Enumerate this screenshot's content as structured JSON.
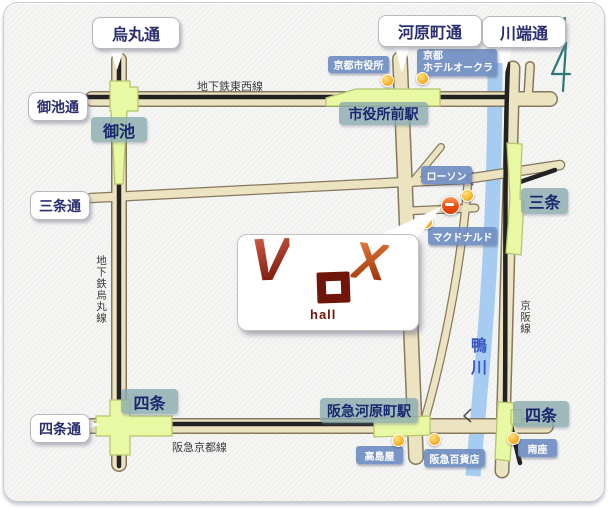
{
  "balloons": {
    "karasuma": "烏丸通",
    "kawaramachi": "河原町通",
    "kawabata": "川端通",
    "oike": "御池通",
    "sanjo": "三条通",
    "shijo": "四条通"
  },
  "stations": {
    "oike": "御池",
    "shiyakushomae": "市役所前駅",
    "sanjo": "三条",
    "shijo_karasuma": "四条",
    "hankyu_kawaramachi": "阪急河原町駅",
    "shijo_keihan": "四条"
  },
  "landmarks": {
    "city_hall": "京都市役所",
    "hotel_okura_line1": "京都",
    "hotel_okura_line2": "ホテルオークラ",
    "lawson": "ローソン",
    "mcdonalds": "マクドナルド",
    "takashimaya": "高島屋",
    "hankyu_dept": "阪急百貨店",
    "minamiza": "南座"
  },
  "rail_labels": {
    "tozai": "地下鉄東西線",
    "karasuma_subway": "地下鉄烏丸線",
    "hankyu_kyoto": "阪急京都線",
    "keihan": "京阪線"
  },
  "river_label": "鴨川",
  "venue": {
    "logo_v": "V",
    "logo_x": "X",
    "logo_sub": "hall"
  },
  "compass_n": "N",
  "colors": {
    "road_fill": "#ece3c1",
    "road_edge": "#84795e",
    "railway": "#222222",
    "river": "#a6cdf1",
    "station_fill": "#e9f8a2",
    "station_edge": "#b5c76e",
    "station_label_bg": "#8caab0",
    "landmark_label_bg": "#7491c4",
    "balloon_text": "#2b2e6e",
    "logo_red": "#8c2013",
    "logo_orange": "#c2551f",
    "venue_dot": "#ee4d12",
    "poi_dot": "#f2a71b",
    "compass": "#2b7a78",
    "river_text": "#3a57c2"
  }
}
